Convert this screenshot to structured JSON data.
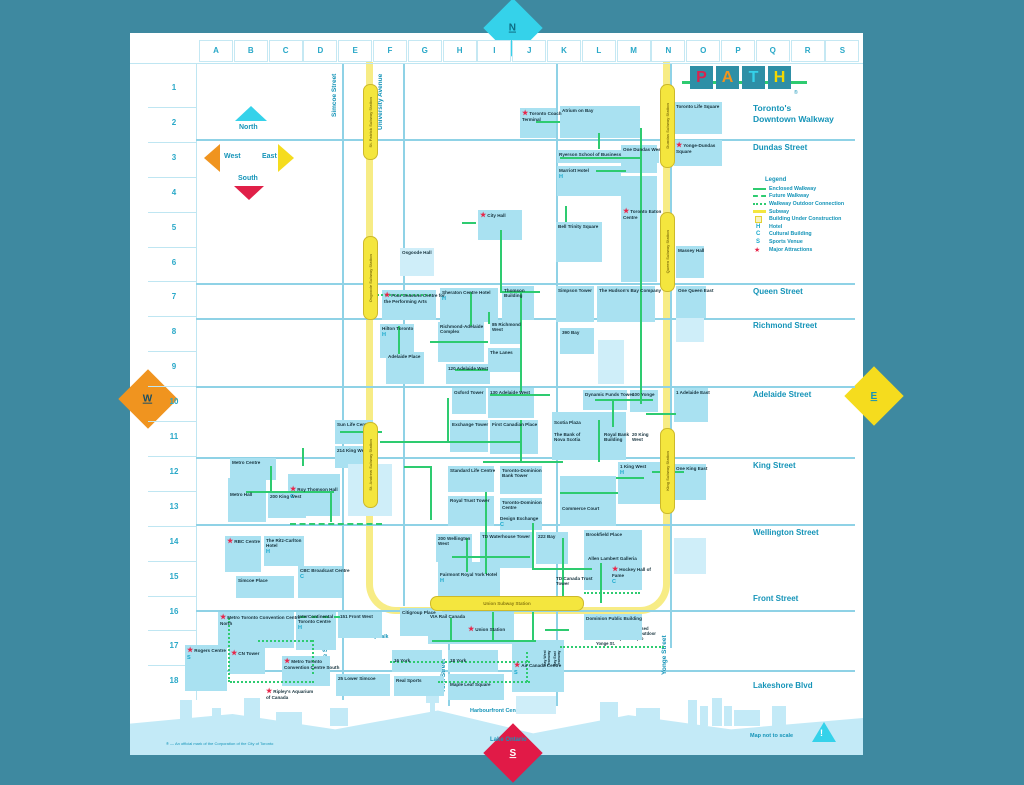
{
  "frame": {
    "north": "N",
    "south": "S",
    "east": "E",
    "west": "W"
  },
  "logo": {
    "letters": [
      {
        "ch": "P",
        "color": "#d8234f"
      },
      {
        "ch": "A",
        "color": "#f0941f"
      },
      {
        "ch": "T",
        "color": "#35d2ea"
      },
      {
        "ch": "H",
        "color": "#f5d800"
      }
    ],
    "registered": "®",
    "tagline_line1": "Toronto's",
    "tagline_line2": "Downtown Walkway"
  },
  "compass": {
    "north": "North",
    "south": "South",
    "east": "East",
    "west": "West"
  },
  "grid": {
    "columns": [
      "A",
      "B",
      "C",
      "D",
      "E",
      "F",
      "G",
      "H",
      "I",
      "J",
      "K",
      "L",
      "M",
      "N",
      "O",
      "P",
      "Q",
      "R",
      "S"
    ],
    "rows": [
      "1",
      "2",
      "3",
      "4",
      "5",
      "6",
      "7",
      "8",
      "9",
      "10",
      "11",
      "12",
      "13",
      "14",
      "15",
      "16",
      "17",
      "18"
    ]
  },
  "legend": {
    "title": "Legend",
    "items": [
      {
        "sym": "solid",
        "label": "Enclosed Walkway"
      },
      {
        "sym": "dash",
        "label": "Future Walkway"
      },
      {
        "sym": "dots",
        "label": "Walkway Outdoor Connection"
      },
      {
        "sym": "subway",
        "label": "Subway"
      },
      {
        "sym": "construction",
        "label": "Building Under Construction"
      },
      {
        "sym": "H",
        "label": "Hotel"
      },
      {
        "sym": "C",
        "label": "Cultural Building"
      },
      {
        "sym": "S",
        "label": "Sports Venue"
      },
      {
        "sym": "star",
        "label": "Major Attractions"
      }
    ]
  },
  "streets": {
    "horizontal": [
      {
        "name": "Dundas Street",
        "y": 139,
        "label_y": 143
      },
      {
        "name": "Queen Street",
        "y": 283,
        "label_y": 287
      },
      {
        "name": "Richmond Street",
        "y": 318,
        "label_y": 321
      },
      {
        "name": "Adelaide Street",
        "y": 386,
        "label_y": 390
      },
      {
        "name": "King Street",
        "y": 457,
        "label_y": 461
      },
      {
        "name": "Wellington Street",
        "y": 524,
        "label_y": 528
      },
      {
        "name": "Front Street",
        "y": 610,
        "label_y": 594
      },
      {
        "name": "Lakeshore Blvd",
        "y": 670,
        "label_y": 681
      }
    ],
    "vertical": [
      {
        "name": "Simcoe Street",
        "x": 342,
        "y0": 64,
        "y1": 700
      },
      {
        "name": "University Avenue",
        "x": 403,
        "y0": 64,
        "y1": 606
      },
      {
        "name": "York Street",
        "x": 448,
        "y0": 556,
        "y1": 706
      },
      {
        "name": "Bay Street",
        "x": 556,
        "y0": 64,
        "y1": 706
      },
      {
        "name": "Yonge Street",
        "x": 670,
        "y0": 64,
        "y1": 648
      }
    ],
    "vertical_labels": [
      {
        "name": "Simcoe Street",
        "x": 331,
        "y": 64,
        "h": 62
      },
      {
        "name": "University Avenue",
        "x": 377,
        "y": 62,
        "h": 80
      },
      {
        "name": "Simcoe Street",
        "x": 322,
        "y": 628,
        "h": 54
      },
      {
        "name": "York Street",
        "x": 440,
        "y": 652,
        "h": 48
      },
      {
        "name": "Bay Street",
        "x": 550,
        "y": 648,
        "h": 56
      },
      {
        "name": "Yonge Street",
        "x": 661,
        "y": 628,
        "h": 54
      }
    ]
  },
  "subway": {
    "stations": [
      {
        "name": "St. Patrick Subway Station",
        "x": 363,
        "y": 84,
        "h": 74
      },
      {
        "name": "Osgoode Subway Station",
        "x": 363,
        "y": 236,
        "h": 82
      },
      {
        "name": "St. Andrew Subway Station",
        "x": 363,
        "y": 422,
        "h": 84
      },
      {
        "name": "Dundas Subway Station",
        "x": 660,
        "y": 84,
        "h": 82
      },
      {
        "name": "Queen Subway Station",
        "x": 660,
        "y": 212,
        "h": 78
      },
      {
        "name": "King Subway Station",
        "x": 660,
        "y": 428,
        "h": 84
      },
      {
        "name": "Union Subway Station",
        "x": 430,
        "y": 596,
        "w": 152,
        "h": 13,
        "horizontal": true
      }
    ]
  },
  "buildings": [
    {
      "l": "Toronto Coach Terminal",
      "x": 520,
      "y": 108,
      "w": 36,
      "h": 30,
      "s": 1
    },
    {
      "l": "Atrium on Bay",
      "x": 560,
      "y": 106,
      "w": 80,
      "h": 32
    },
    {
      "l": "Toronto Life Square",
      "x": 674,
      "y": 102,
      "w": 48,
      "h": 32
    },
    {
      "l": "Yonge-Dundas Square",
      "x": 674,
      "y": 140,
      "w": 48,
      "h": 26,
      "s": 1
    },
    {
      "l": "Ryerson School of Business",
      "x": 557,
      "y": 150,
      "w": 102,
      "h": 13
    },
    {
      "l": "Marriott Hotel",
      "x": 557,
      "y": 166,
      "w": 64,
      "h": 30,
      "b": "H"
    },
    {
      "l": "One Dundas West",
      "x": 621,
      "y": 145,
      "w": 36,
      "h": 28
    },
    {
      "l": "Toronto Eaton Centre",
      "x": 621,
      "y": 176,
      "w": 36,
      "h": 106,
      "s": 1,
      "pt": 30
    },
    {
      "l": "Bell Trinity Square",
      "x": 556,
      "y": 222,
      "w": 46,
      "h": 40
    },
    {
      "l": "City Hall",
      "x": 478,
      "y": 210,
      "w": 44,
      "h": 30,
      "s": 1
    },
    {
      "l": "Massey Hall",
      "x": 676,
      "y": 246,
      "w": 28,
      "h": 32
    },
    {
      "l": "Osgoode Hall",
      "x": 400,
      "y": 248,
      "w": 34,
      "h": 28,
      "pale": 1
    },
    {
      "l": "Four Seasons Centre for the Performing Arts",
      "x": 382,
      "y": 290,
      "w": 54,
      "h": 30,
      "s": 1
    },
    {
      "l": "Sheraton Centre Hotel",
      "x": 440,
      "y": 288,
      "w": 58,
      "h": 34,
      "b": "H"
    },
    {
      "l": "Thomson Building",
      "x": 502,
      "y": 286,
      "w": 32,
      "h": 34
    },
    {
      "l": "Simpson Tower",
      "x": 556,
      "y": 286,
      "w": 38,
      "h": 36
    },
    {
      "l": "The Hudson's Bay Company",
      "x": 597,
      "y": 286,
      "w": 58,
      "h": 36
    },
    {
      "l": "One Queen East",
      "x": 676,
      "y": 286,
      "w": 30,
      "h": 32
    },
    {
      "l": "Hilton Toronto",
      "x": 380,
      "y": 324,
      "w": 34,
      "h": 34,
      "b": "H"
    },
    {
      "l": "Richmond-Adelaide Complex",
      "x": 438,
      "y": 322,
      "w": 46,
      "h": 40
    },
    {
      "l": "85 Richmond West",
      "x": 490,
      "y": 320,
      "w": 32,
      "h": 24
    },
    {
      "l": "The Lanes",
      "x": 488,
      "y": 348,
      "w": 34,
      "h": 24
    },
    {
      "l": "120 Adelaide West",
      "x": 446,
      "y": 364,
      "w": 44,
      "h": 20
    },
    {
      "l": "Adelaide Place",
      "x": 386,
      "y": 352,
      "w": 38,
      "h": 32
    },
    {
      "l": "390 Bay",
      "x": 560,
      "y": 328,
      "w": 34,
      "h": 26
    },
    {
      "l": "",
      "x": 598,
      "y": 340,
      "w": 26,
      "h": 44,
      "pale": 1
    },
    {
      "l": "",
      "x": 676,
      "y": 318,
      "w": 28,
      "h": 24,
      "pale": 1
    },
    {
      "l": "Sun Life Centre",
      "x": 335,
      "y": 420,
      "w": 38,
      "h": 24
    },
    {
      "l": "214 King West",
      "x": 335,
      "y": 446,
      "w": 38,
      "h": 22
    },
    {
      "l": "Oxford Tower",
      "x": 452,
      "y": 388,
      "w": 34,
      "h": 26
    },
    {
      "l": "130 Adelaide West",
      "x": 488,
      "y": 388,
      "w": 46,
      "h": 30
    },
    {
      "l": "Exchange Tower",
      "x": 450,
      "y": 420,
      "w": 38,
      "h": 32
    },
    {
      "l": "First Canadian Place",
      "x": 490,
      "y": 420,
      "w": 48,
      "h": 34
    },
    {
      "l": "Scotia Plaza",
      "x": 552,
      "y": 412,
      "w": 74,
      "h": 48,
      "pt": 6
    },
    {
      "l": "The Bank of Nova Scotia",
      "x": 554,
      "y": 432,
      "w": 34,
      "h": 20,
      "nb": 1
    },
    {
      "l": "Royal Bank Building",
      "x": 604,
      "y": 432,
      "w": 26,
      "h": 18,
      "nb": 1
    },
    {
      "l": "20 King West",
      "x": 632,
      "y": 432,
      "w": 22,
      "h": 16,
      "nb": 1
    },
    {
      "l": "Dynamic Funds Tower",
      "x": 583,
      "y": 390,
      "w": 44,
      "h": 20
    },
    {
      "l": "100 Yonge",
      "x": 630,
      "y": 390,
      "w": 28,
      "h": 22
    },
    {
      "l": "1 Adelaide East",
      "x": 674,
      "y": 388,
      "w": 34,
      "h": 34
    },
    {
      "l": "Metro Centre",
      "x": 230,
      "y": 458,
      "w": 46,
      "h": 22
    },
    {
      "l": "Metro Hall",
      "x": 228,
      "y": 478,
      "w": 38,
      "h": 44,
      "pt": 12
    },
    {
      "l": "200 King West",
      "x": 268,
      "y": 492,
      "w": 38,
      "h": 26
    },
    {
      "l": "Roy Thomson Hall",
      "x": 288,
      "y": 474,
      "w": 52,
      "h": 42,
      "s": 1,
      "b": "C",
      "pt": 10
    },
    {
      "l": "",
      "x": 348,
      "y": 464,
      "w": 44,
      "h": 52,
      "pale": 1
    },
    {
      "l": "Standard Life Centre",
      "x": 448,
      "y": 466,
      "w": 46,
      "h": 26
    },
    {
      "l": "Royal Trust Tower",
      "x": 448,
      "y": 496,
      "w": 46,
      "h": 30
    },
    {
      "l": "Toronto-Dominion Bank Tower",
      "x": 500,
      "y": 466,
      "w": 42,
      "h": 28
    },
    {
      "l": "Toronto-Dominion Centre",
      "x": 500,
      "y": 498,
      "w": 42,
      "h": 32
    },
    {
      "l": "Design Exchange",
      "x": 500,
      "y": 516,
      "w": 42,
      "h": 14,
      "nb": 1,
      "b": "C"
    },
    {
      "l": "Commerce Court",
      "x": 560,
      "y": 476,
      "w": 56,
      "h": 50,
      "pt": 28
    },
    {
      "l": "1 King West",
      "x": 618,
      "y": 462,
      "w": 44,
      "h": 42,
      "b": "H"
    },
    {
      "l": "One King East",
      "x": 674,
      "y": 464,
      "w": 32,
      "h": 36
    },
    {
      "l": "RBC Centre",
      "x": 225,
      "y": 536,
      "w": 36,
      "h": 36,
      "s": 1
    },
    {
      "l": "The Ritz-Carlton Hotel",
      "x": 264,
      "y": 536,
      "w": 40,
      "h": 30,
      "b": "H"
    },
    {
      "l": "Simcoe Place",
      "x": 236,
      "y": 576,
      "w": 58,
      "h": 22
    },
    {
      "l": "CBC Broadcast Centre",
      "x": 298,
      "y": 566,
      "w": 44,
      "h": 32,
      "b": "C"
    },
    {
      "l": "200 Wellington West",
      "x": 436,
      "y": 534,
      "w": 36,
      "h": 28
    },
    {
      "l": "TD Waterhouse Tower",
      "x": 480,
      "y": 532,
      "w": 52,
      "h": 36
    },
    {
      "l": "222 Bay",
      "x": 536,
      "y": 532,
      "w": 32,
      "h": 32
    },
    {
      "l": "Fairmont Royal York Hotel",
      "x": 438,
      "y": 562,
      "w": 62,
      "h": 34,
      "b": "H",
      "pt": 8
    },
    {
      "l": "Brookfield Place",
      "x": 584,
      "y": 530,
      "w": 58,
      "h": 60
    },
    {
      "l": "Allen Lambert Galleria",
      "x": 588,
      "y": 556,
      "w": 52,
      "h": 10,
      "nb": 1
    },
    {
      "l": "TD Canada Trust Tower",
      "x": 556,
      "y": 576,
      "w": 40,
      "h": 20,
      "nb": 1
    },
    {
      "l": "Hockey Hall of Fame",
      "x": 612,
      "y": 566,
      "w": 44,
      "h": 22,
      "s": 1,
      "b": "C",
      "nb": 1
    },
    {
      "l": "",
      "x": 674,
      "y": 538,
      "w": 32,
      "h": 36,
      "pale": 1
    },
    {
      "l": "Metro Toronto Convention Centre North",
      "x": 218,
      "y": 612,
      "w": 76,
      "h": 36,
      "s": 1
    },
    {
      "l": "InterContinental Toronto Centre",
      "x": 296,
      "y": 612,
      "w": 40,
      "h": 38,
      "b": "H"
    },
    {
      "l": "151 Front West",
      "x": 338,
      "y": 612,
      "w": 44,
      "h": 26
    },
    {
      "l": "Citigroup Place",
      "x": 400,
      "y": 608,
      "w": 42,
      "h": 28
    },
    {
      "l": "Rogers Centre",
      "x": 185,
      "y": 645,
      "w": 42,
      "h": 46,
      "s": 1,
      "b": "S"
    },
    {
      "l": "CN Tower",
      "x": 229,
      "y": 648,
      "w": 36,
      "h": 26,
      "s": 1
    },
    {
      "l": "Metro Toronto Convention Centre South",
      "x": 282,
      "y": 656,
      "w": 48,
      "h": 30,
      "s": 1
    },
    {
      "l": "Ripley's Aquarium of Canada",
      "x": 266,
      "y": 688,
      "w": 50,
      "h": 14,
      "s": 1,
      "nb": 1
    },
    {
      "l": "16 York",
      "x": 392,
      "y": 650,
      "w": 50,
      "h": 22,
      "pt": 6
    },
    {
      "l": "18 York",
      "x": 448,
      "y": 650,
      "w": 50,
      "h": 22,
      "pt": 6
    },
    {
      "l": "25 Lower Simcoe",
      "x": 336,
      "y": 674,
      "w": 54,
      "h": 22
    },
    {
      "l": "Real Sports",
      "x": 394,
      "y": 676,
      "w": 50,
      "h": 20
    },
    {
      "l": "Maple Leaf Square",
      "x": 448,
      "y": 674,
      "w": 56,
      "h": 26,
      "pt": 6
    },
    {
      "l": "Air Canada Centre",
      "x": 512,
      "y": 640,
      "w": 52,
      "h": 52,
      "s": 1,
      "b": "S",
      "pt": 20
    },
    {
      "l": "VIA Rail Canada",
      "x": 428,
      "y": 612,
      "w": 86,
      "h": 32
    },
    {
      "l": "Union Station",
      "x": 468,
      "y": 626,
      "w": 40,
      "h": 12,
      "s": 1,
      "nb": 1
    },
    {
      "l": "Dominion Public Building",
      "x": 584,
      "y": 614,
      "w": 58,
      "h": 26
    },
    {
      "l": "Bay West Teamway",
      "x": 544,
      "y": 636,
      "w": 9,
      "h": 30,
      "rot": 1,
      "nb": 1
    },
    {
      "l": "Bay East Teamway",
      "x": 554,
      "y": 636,
      "w": 9,
      "h": 30,
      "rot": 1,
      "nb": 1
    },
    {
      "l": "",
      "x": 516,
      "y": 696,
      "w": 40,
      "h": 18,
      "pale": 1
    }
  ],
  "walkways": [
    [
      536,
      121,
      24,
      "h",
      0
    ],
    [
      560,
      157,
      82,
      "h",
      0
    ],
    [
      500,
      291,
      40,
      "h",
      0
    ],
    [
      373,
      294,
      58,
      "h",
      2
    ],
    [
      430,
      341,
      58,
      "h",
      0
    ],
    [
      455,
      369,
      33,
      "h",
      0
    ],
    [
      380,
      441,
      140,
      "h",
      0
    ],
    [
      340,
      431,
      42,
      "h",
      0
    ],
    [
      595,
      399,
      58,
      "h",
      0
    ],
    [
      646,
      413,
      30,
      "h",
      0
    ],
    [
      483,
      461,
      80,
      "h",
      0
    ],
    [
      560,
      492,
      58,
      "h",
      0
    ],
    [
      616,
      477,
      28,
      "h",
      0
    ],
    [
      652,
      471,
      32,
      "h",
      0
    ],
    [
      246,
      491,
      88,
      "h",
      0
    ],
    [
      290,
      523,
      92,
      "h",
      1
    ],
    [
      452,
      556,
      78,
      "h",
      0
    ],
    [
      532,
      568,
      60,
      "h",
      0
    ],
    [
      584,
      592,
      56,
      "h",
      2
    ],
    [
      432,
      640,
      104,
      "h",
      0
    ],
    [
      545,
      629,
      24,
      "h",
      0
    ],
    [
      390,
      661,
      140,
      "h",
      2
    ],
    [
      438,
      681,
      92,
      "h",
      2
    ],
    [
      560,
      646,
      104,
      "h",
      2
    ],
    [
      230,
      681,
      84,
      "h",
      2
    ],
    [
      258,
      640,
      54,
      "h",
      2
    ],
    [
      300,
      616,
      40,
      "h",
      1
    ],
    [
      462,
      222,
      14,
      "h",
      0
    ],
    [
      596,
      170,
      30,
      "h",
      0
    ],
    [
      490,
      394,
      60,
      "h",
      0
    ],
    [
      404,
      466,
      28,
      "h",
      0
    ],
    [
      598,
      133,
      16,
      "v",
      0
    ],
    [
      640,
      128,
      276,
      "v",
      0
    ],
    [
      565,
      206,
      16,
      "v",
      0
    ],
    [
      500,
      230,
      62,
      "v",
      0
    ],
    [
      470,
      292,
      34,
      "v",
      0
    ],
    [
      398,
      326,
      28,
      "v",
      0
    ],
    [
      488,
      312,
      12,
      "v",
      0
    ],
    [
      520,
      292,
      100,
      "v",
      0
    ],
    [
      447,
      398,
      44,
      "v",
      0
    ],
    [
      612,
      399,
      28,
      "v",
      0
    ],
    [
      598,
      420,
      42,
      "v",
      0
    ],
    [
      520,
      420,
      42,
      "v",
      0
    ],
    [
      430,
      466,
      54,
      "v",
      0
    ],
    [
      485,
      492,
      82,
      "v",
      0
    ],
    [
      330,
      492,
      30,
      "v",
      0
    ],
    [
      270,
      466,
      26,
      "v",
      0
    ],
    [
      302,
      448,
      18,
      "v",
      0
    ],
    [
      466,
      538,
      34,
      "v",
      0
    ],
    [
      532,
      523,
      46,
      "v",
      0
    ],
    [
      562,
      538,
      58,
      "v",
      0
    ],
    [
      600,
      563,
      40,
      "v",
      0
    ],
    [
      450,
      618,
      24,
      "v",
      0
    ],
    [
      492,
      612,
      30,
      "v",
      0
    ],
    [
      532,
      612,
      30,
      "v",
      0
    ],
    [
      526,
      652,
      30,
      "v",
      2
    ],
    [
      228,
      618,
      64,
      "v",
      2
    ],
    [
      312,
      640,
      34,
      "v",
      2
    ]
  ],
  "skyline": [
    [
      180,
      700,
      12,
      26
    ],
    [
      212,
      708,
      9,
      18
    ],
    [
      244,
      698,
      16,
      28
    ],
    [
      276,
      712,
      26,
      14
    ],
    [
      330,
      708,
      18,
      18
    ],
    [
      430,
      686,
      5,
      40
    ],
    [
      426,
      696,
      13,
      7
    ],
    [
      600,
      702,
      18,
      24
    ],
    [
      636,
      708,
      24,
      18
    ],
    [
      688,
      700,
      9,
      26
    ],
    [
      700,
      706,
      8,
      20
    ],
    [
      712,
      698,
      10,
      28
    ],
    [
      724,
      706,
      8,
      20
    ],
    [
      734,
      710,
      26,
      16
    ],
    [
      772,
      706,
      14,
      20
    ]
  ],
  "notes": {
    "bay_note": "Bay Teamway — Enclosed Walkway over Bay St. outdoor connection (covered) to Yonge St.",
    "skywalk": "SkyWalk",
    "harbourfront": "Harbourfront Centre",
    "lake": "Lake Ontario",
    "footnote": "® — An official mark of the Corporation of the City of Toronto",
    "scale": "Map not to scale"
  },
  "colors": {
    "frame": "#3e89a0",
    "accent": "#1594b8",
    "building": "#a9e1f1",
    "walkway": "#2ecb70",
    "subway": "#f4e63e",
    "star": "#e8274b",
    "water": "#c3eaf7",
    "badge": "#1aa9cc"
  }
}
